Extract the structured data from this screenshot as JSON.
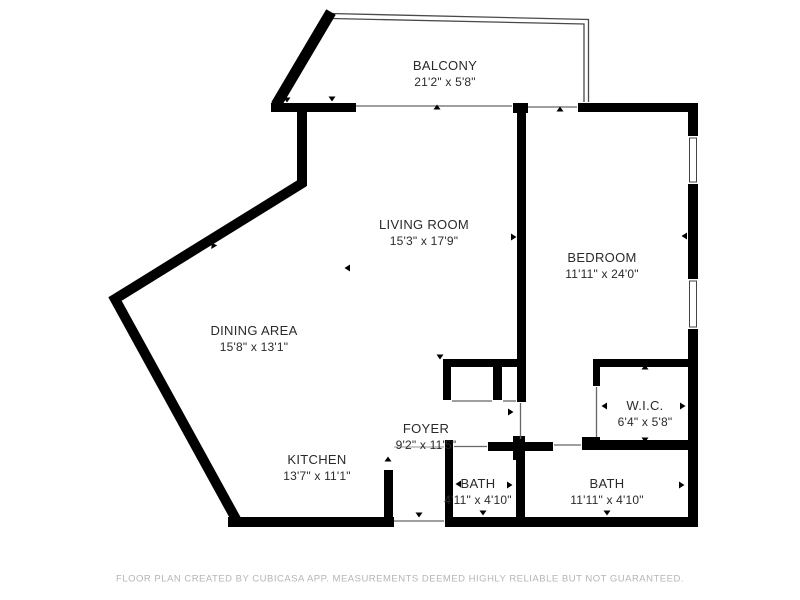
{
  "floor_plan": {
    "footer": "FLOOR PLAN CREATED BY CUBICASA APP. MEASUREMENTS DEEMED HIGHLY RELIABLE BUT NOT GUARANTEED.",
    "rooms": {
      "balcony": {
        "name": "BALCONY",
        "dims": "21'2\" x 5'8\""
      },
      "living_room": {
        "name": "LIVING ROOM",
        "dims": "15'3\" x 17'9\""
      },
      "bedroom": {
        "name": "BEDROOM",
        "dims": "11'11\" x 24'0\""
      },
      "dining_area": {
        "name": "DINING AREA",
        "dims": "15'8\" x 13'1\""
      },
      "kitchen": {
        "name": "KITCHEN",
        "dims": "13'7\" x 11'1\""
      },
      "foyer": {
        "name": "FOYER",
        "dims": "9'2\" x 11'5\""
      },
      "wic": {
        "name": "W.I.C.",
        "dims": "6'4\" x 5'8\""
      },
      "bath_1": {
        "name": "BATH",
        "dims": "4'11\" x 4'10\""
      },
      "bath_2": {
        "name": "BATH",
        "dims": "11'11\" x 4'10\""
      }
    },
    "colors": {
      "wall": "#000000",
      "door_line": "#666666",
      "railing": "#4a4a4a",
      "label": "#2a2a2a",
      "footer": "#b5b5b5",
      "background": "#ffffff"
    }
  }
}
